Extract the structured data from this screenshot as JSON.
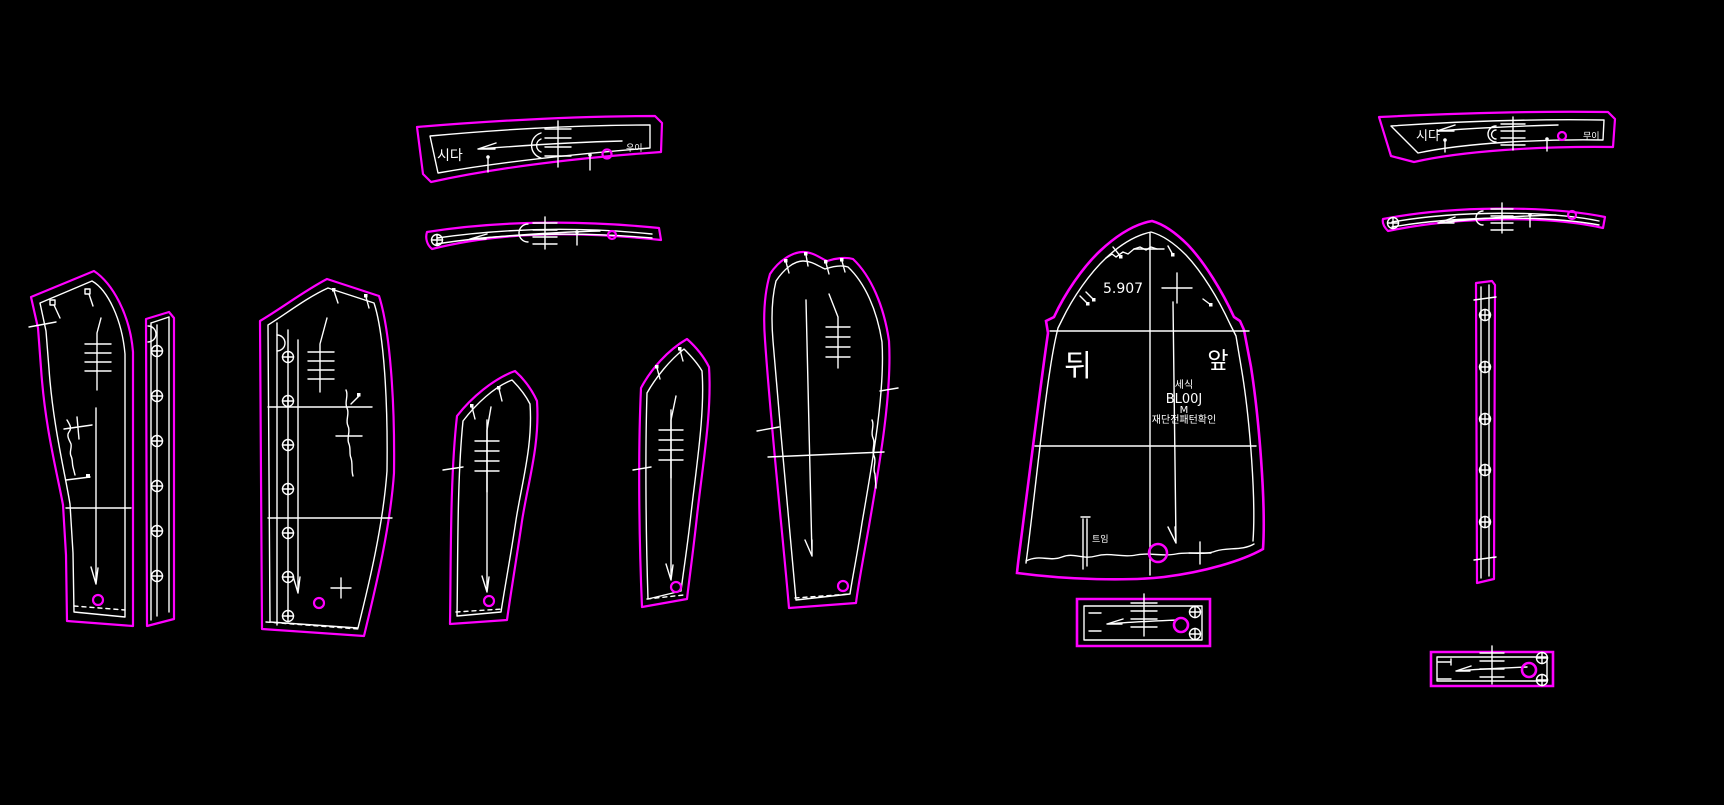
{
  "colors": {
    "background": "#000000",
    "outline": "#ff00ff",
    "line": "#ffffff"
  },
  "pieces": {
    "collar_band_upper_left": {
      "label_left": "시다",
      "label_right": "우이"
    },
    "collar_band_upper_right": {
      "label_left": "시다",
      "label_right": "무이"
    },
    "body_main": {
      "back_label": "뒤",
      "front_label": "앞",
      "measurement": "5.907",
      "info_line1": "세식",
      "info_line2": "BL00J",
      "info_line3": "M",
      "info_line4": "재단전패턴확인",
      "vent_label": "트임"
    }
  }
}
